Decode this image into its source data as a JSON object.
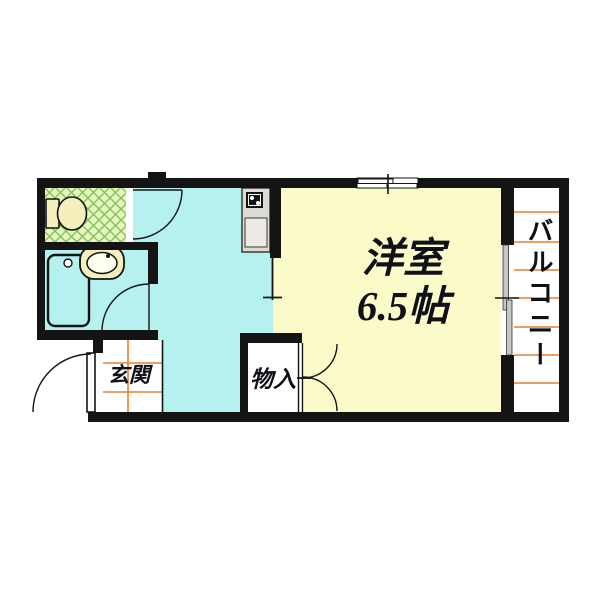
{
  "floorplan": {
    "rooms": {
      "western_room": {
        "name": "洋室",
        "size": "6.5帖"
      },
      "balcony": {
        "name": "バルコニー"
      },
      "entrance": {
        "name": "玄関"
      },
      "storage": {
        "name": "物入"
      }
    },
    "colors": {
      "wall": "#141414",
      "kitchen_floor": "#b5f1ef",
      "room_floor": "#fbfac9",
      "toilet_floor": "#e8f6c0",
      "toilet_hatch_line": "#7ec457",
      "fixture_cream": "#f4efbc",
      "counter_gray": "#dcdcd4",
      "sink_gray": "#eceae2",
      "orange_line": "#e6812e",
      "window_panel_gray": "#c6c6c6",
      "text": "#101018"
    }
  }
}
